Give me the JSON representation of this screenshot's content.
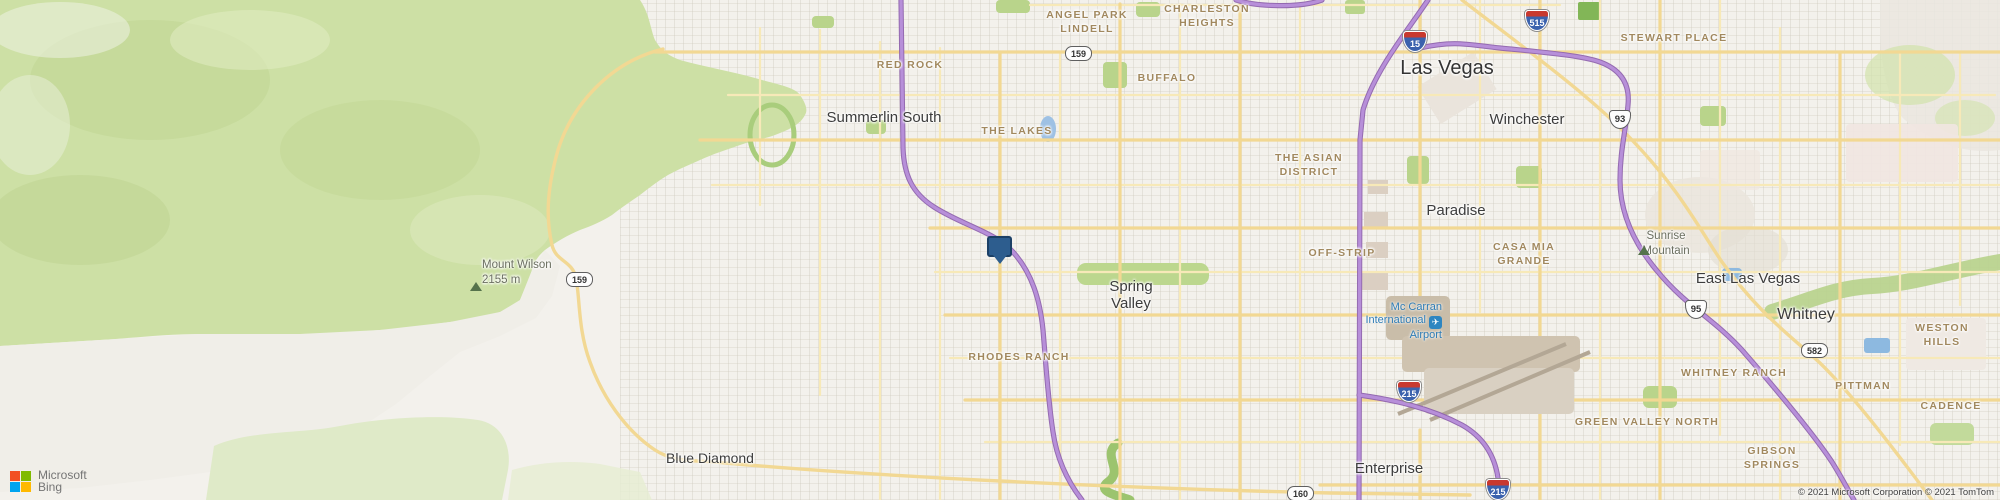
{
  "title": "Bing Maps — Las Vegas area",
  "attribution": {
    "logo_company": "Microsoft",
    "logo_product": "Bing",
    "copyright": "© 2021 Microsoft Corporation © 2021 TomTom"
  },
  "labels": {
    "cities": [
      {
        "text": "Las Vegas"
      },
      {
        "text": "Summerlin South"
      },
      {
        "text": "Winchester"
      },
      {
        "text": "Paradise"
      },
      {
        "text": "Spring\nValley"
      },
      {
        "text": "East Las Vegas"
      },
      {
        "text": "Whitney"
      },
      {
        "text": "Enterprise"
      },
      {
        "text": "Blue Diamond"
      }
    ],
    "neighborhoods": [
      {
        "text": "ANGEL PARK\nLINDELL"
      },
      {
        "text": "CHARLESTON\nHEIGHTS"
      },
      {
        "text": "RED ROCK"
      },
      {
        "text": "BUFFALO"
      },
      {
        "text": "THE LAKES"
      },
      {
        "text": "THE ASIAN\nDISTRICT"
      },
      {
        "text": "OFF-STRIP"
      },
      {
        "text": "CASA MIA\nGRANDE"
      },
      {
        "text": "STEWART PLACE"
      },
      {
        "text": "WESTON HILLS"
      },
      {
        "text": "RHODES RANCH"
      },
      {
        "text": "WHITNEY RANCH"
      },
      {
        "text": "PITTMAN"
      },
      {
        "text": "CADENCE"
      },
      {
        "text": "GREEN VALLEY NORTH"
      },
      {
        "text": "GIBSON\nSPRINGS"
      }
    ],
    "mountains": [
      {
        "text": "Mount Wilson\n2155 m"
      },
      {
        "text": "Sunrise\nMountain"
      }
    ],
    "airport": {
      "line1": "Mc Carran",
      "line2": "International",
      "line3": "Airport"
    }
  },
  "shields": {
    "interstate": [
      {
        "number": "15"
      },
      {
        "number": "515"
      },
      {
        "number": "215"
      },
      {
        "number": "215"
      }
    ],
    "us": [
      {
        "number": "93"
      },
      {
        "number": "95"
      }
    ],
    "state": [
      {
        "number": "159"
      },
      {
        "number": "159"
      },
      {
        "number": "582"
      },
      {
        "number": "160"
      }
    ]
  },
  "colors": {
    "terrain_green": "#cde0a5",
    "road_minor": "#f7e9b8",
    "road_major": "#f2d893",
    "highway_purple": "#b78fd9",
    "highway_casing": "#8f63ae",
    "marker_blue": "#2d5d8e",
    "water_blue": "#9ec1e4",
    "city_label": "#3c3c3c",
    "neighborhood_label": "#a1885e",
    "airport_label": "#2e7cb5"
  }
}
